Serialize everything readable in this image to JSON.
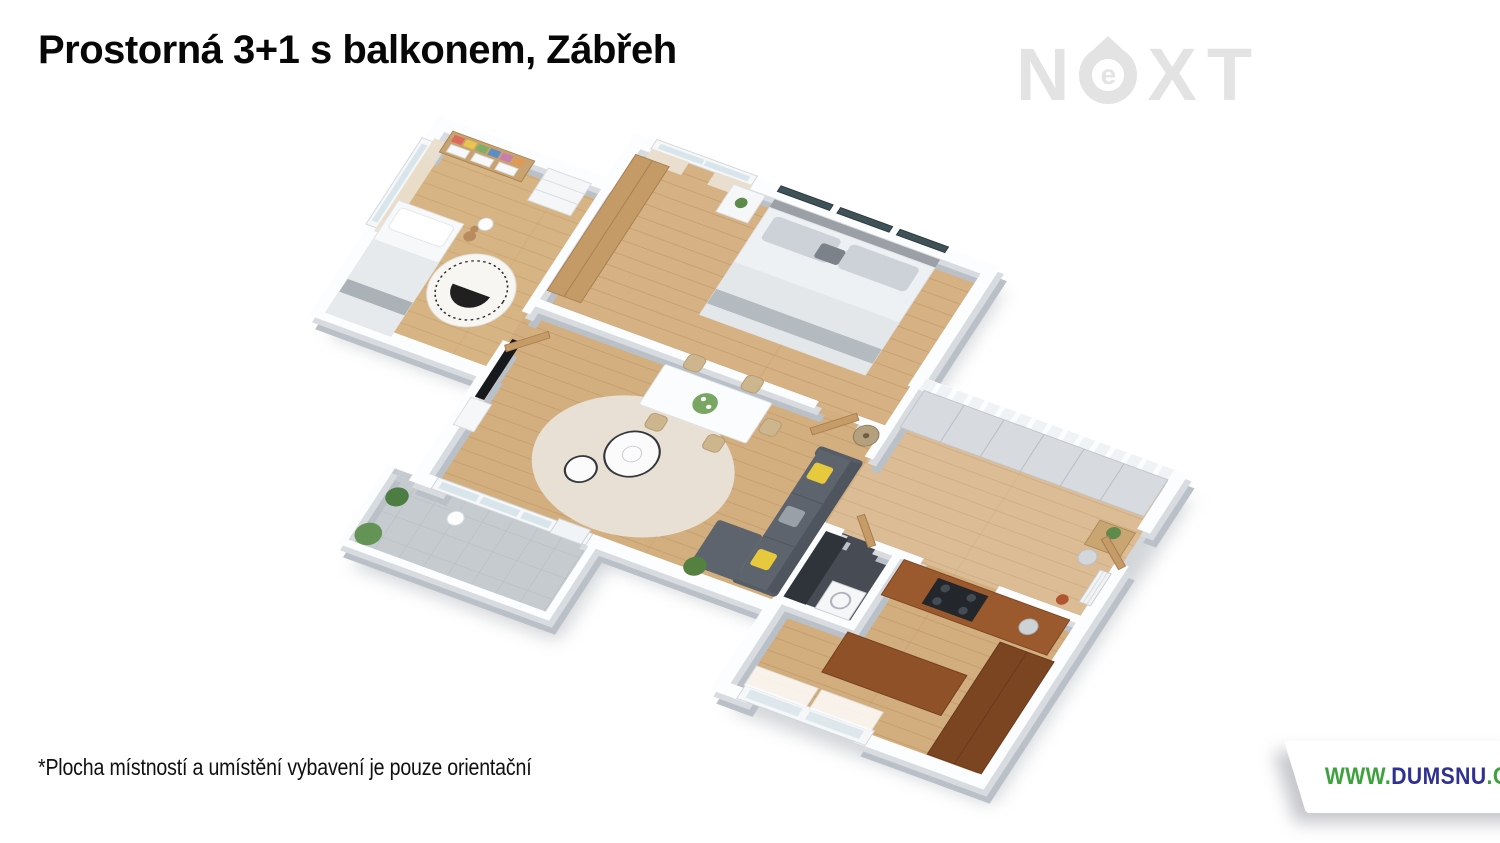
{
  "page": {
    "background": "#ffffff"
  },
  "header": {
    "title": "Prostorná 3+1 s balkonem, Zábřeh"
  },
  "watermark": {
    "letter_n": "N",
    "letter_e": "e",
    "letter_x": "X",
    "letter_t": "T"
  },
  "floorplan": {
    "rooms": [
      "master bedroom",
      "children's room",
      "living room with dining area",
      "hallway",
      "kitchen",
      "bathroom",
      "balcony"
    ]
  },
  "footer": {
    "disclaimer": "*Plocha místností a umístění vybavení je pouze orientační"
  },
  "banner": {
    "url_prefix": "WWW.",
    "url_name": "DUMSNU",
    "url_suffix": ".COM"
  },
  "colors": {
    "url_green": "#3ba23c",
    "url_navy": "#2e3192",
    "watermark_gray": "#e3e3e3",
    "wood_floor": "#d5b183",
    "balcony_floor": "#c6cbd0",
    "kitchen_cabinet": "#9a5a2e",
    "sofa_gray": "#5d646d",
    "accent_yellow": "#e6c93c",
    "door_wood": "#c59c68"
  }
}
